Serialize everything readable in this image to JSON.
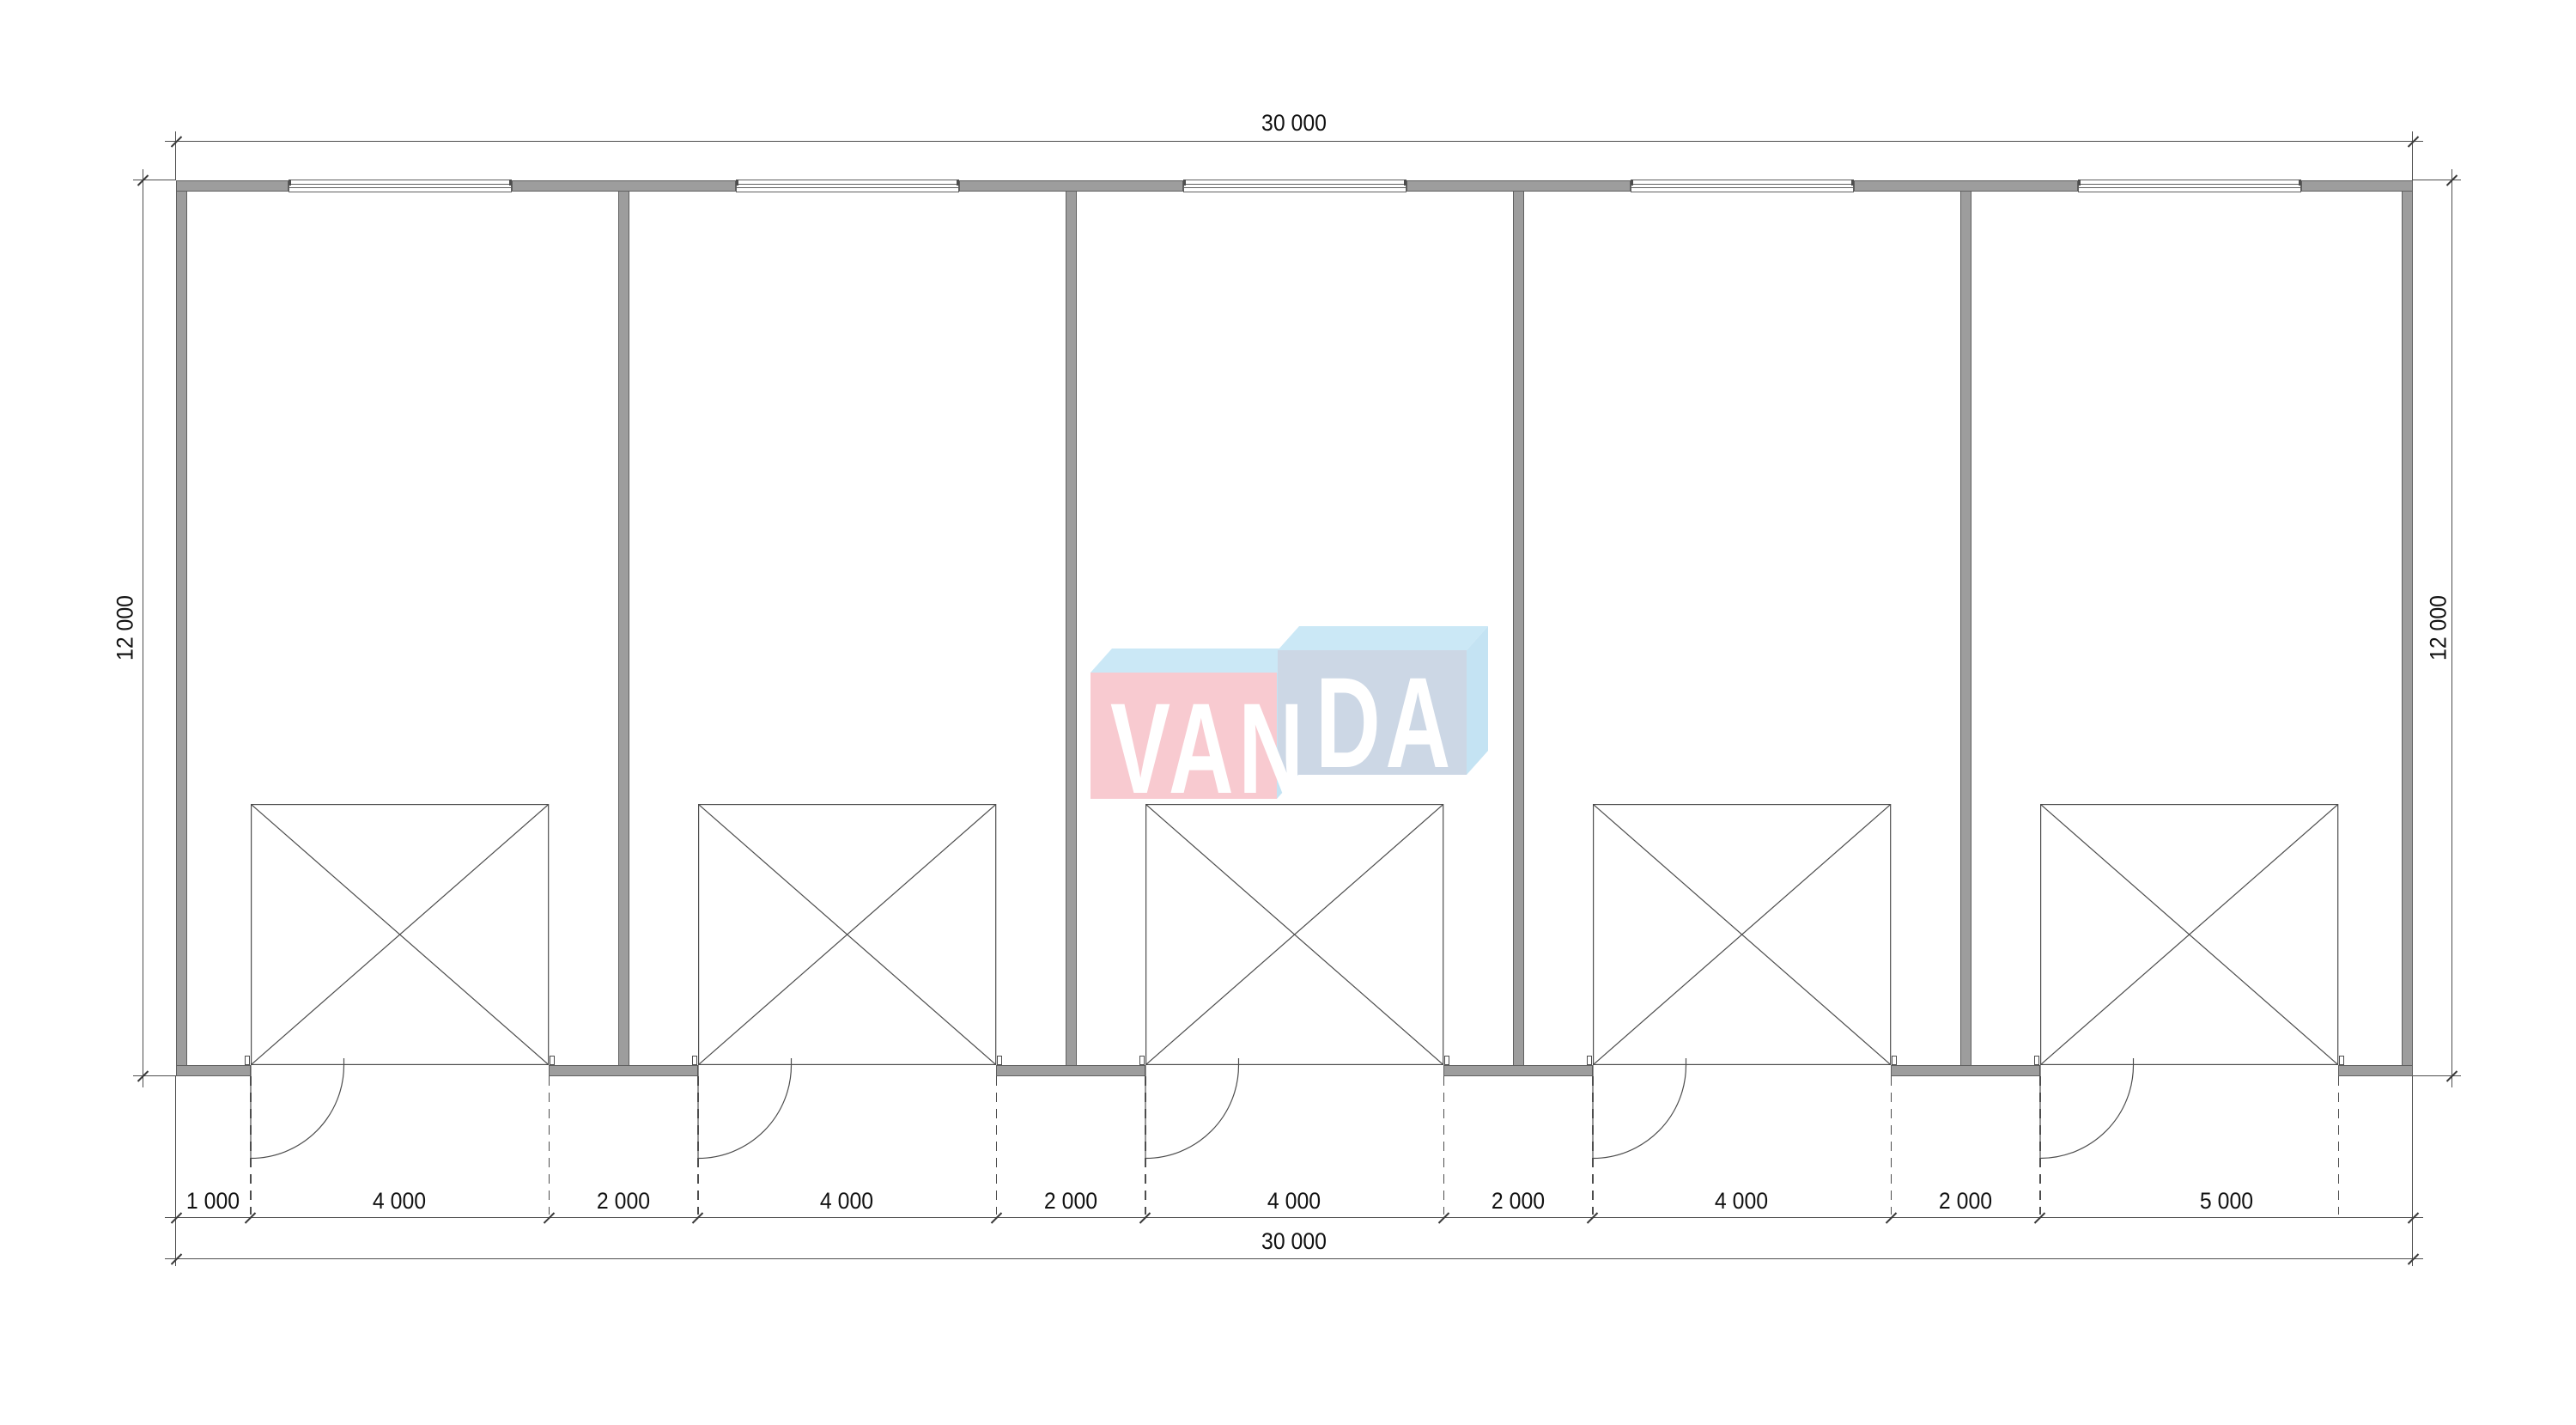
{
  "dims": {
    "top": "30 000",
    "bottom_total": "30 000",
    "left": "12 000",
    "right": "12 000",
    "chain": [
      "1 000",
      "4 000",
      "2 000",
      "4 000",
      "2 000",
      "4 000",
      "2 000",
      "4 000",
      "2 000",
      "5 000"
    ]
  },
  "logo": {
    "left_text": "VAN",
    "right_text": "DA",
    "full_name": "VANDA"
  },
  "colors": {
    "wall_fill": "#9d9d9d",
    "wall_edge": "#5f5f5f",
    "drawing_line": "#4d4d4d",
    "dimension_text": "#121212",
    "logo_pink": "#f8cad0",
    "logo_light_blue": "#cbe8f6",
    "logo_side_blue": "#c4e3f3",
    "logo_blue_gray": "#ccd7e5",
    "logo_text": "#ffffff"
  }
}
